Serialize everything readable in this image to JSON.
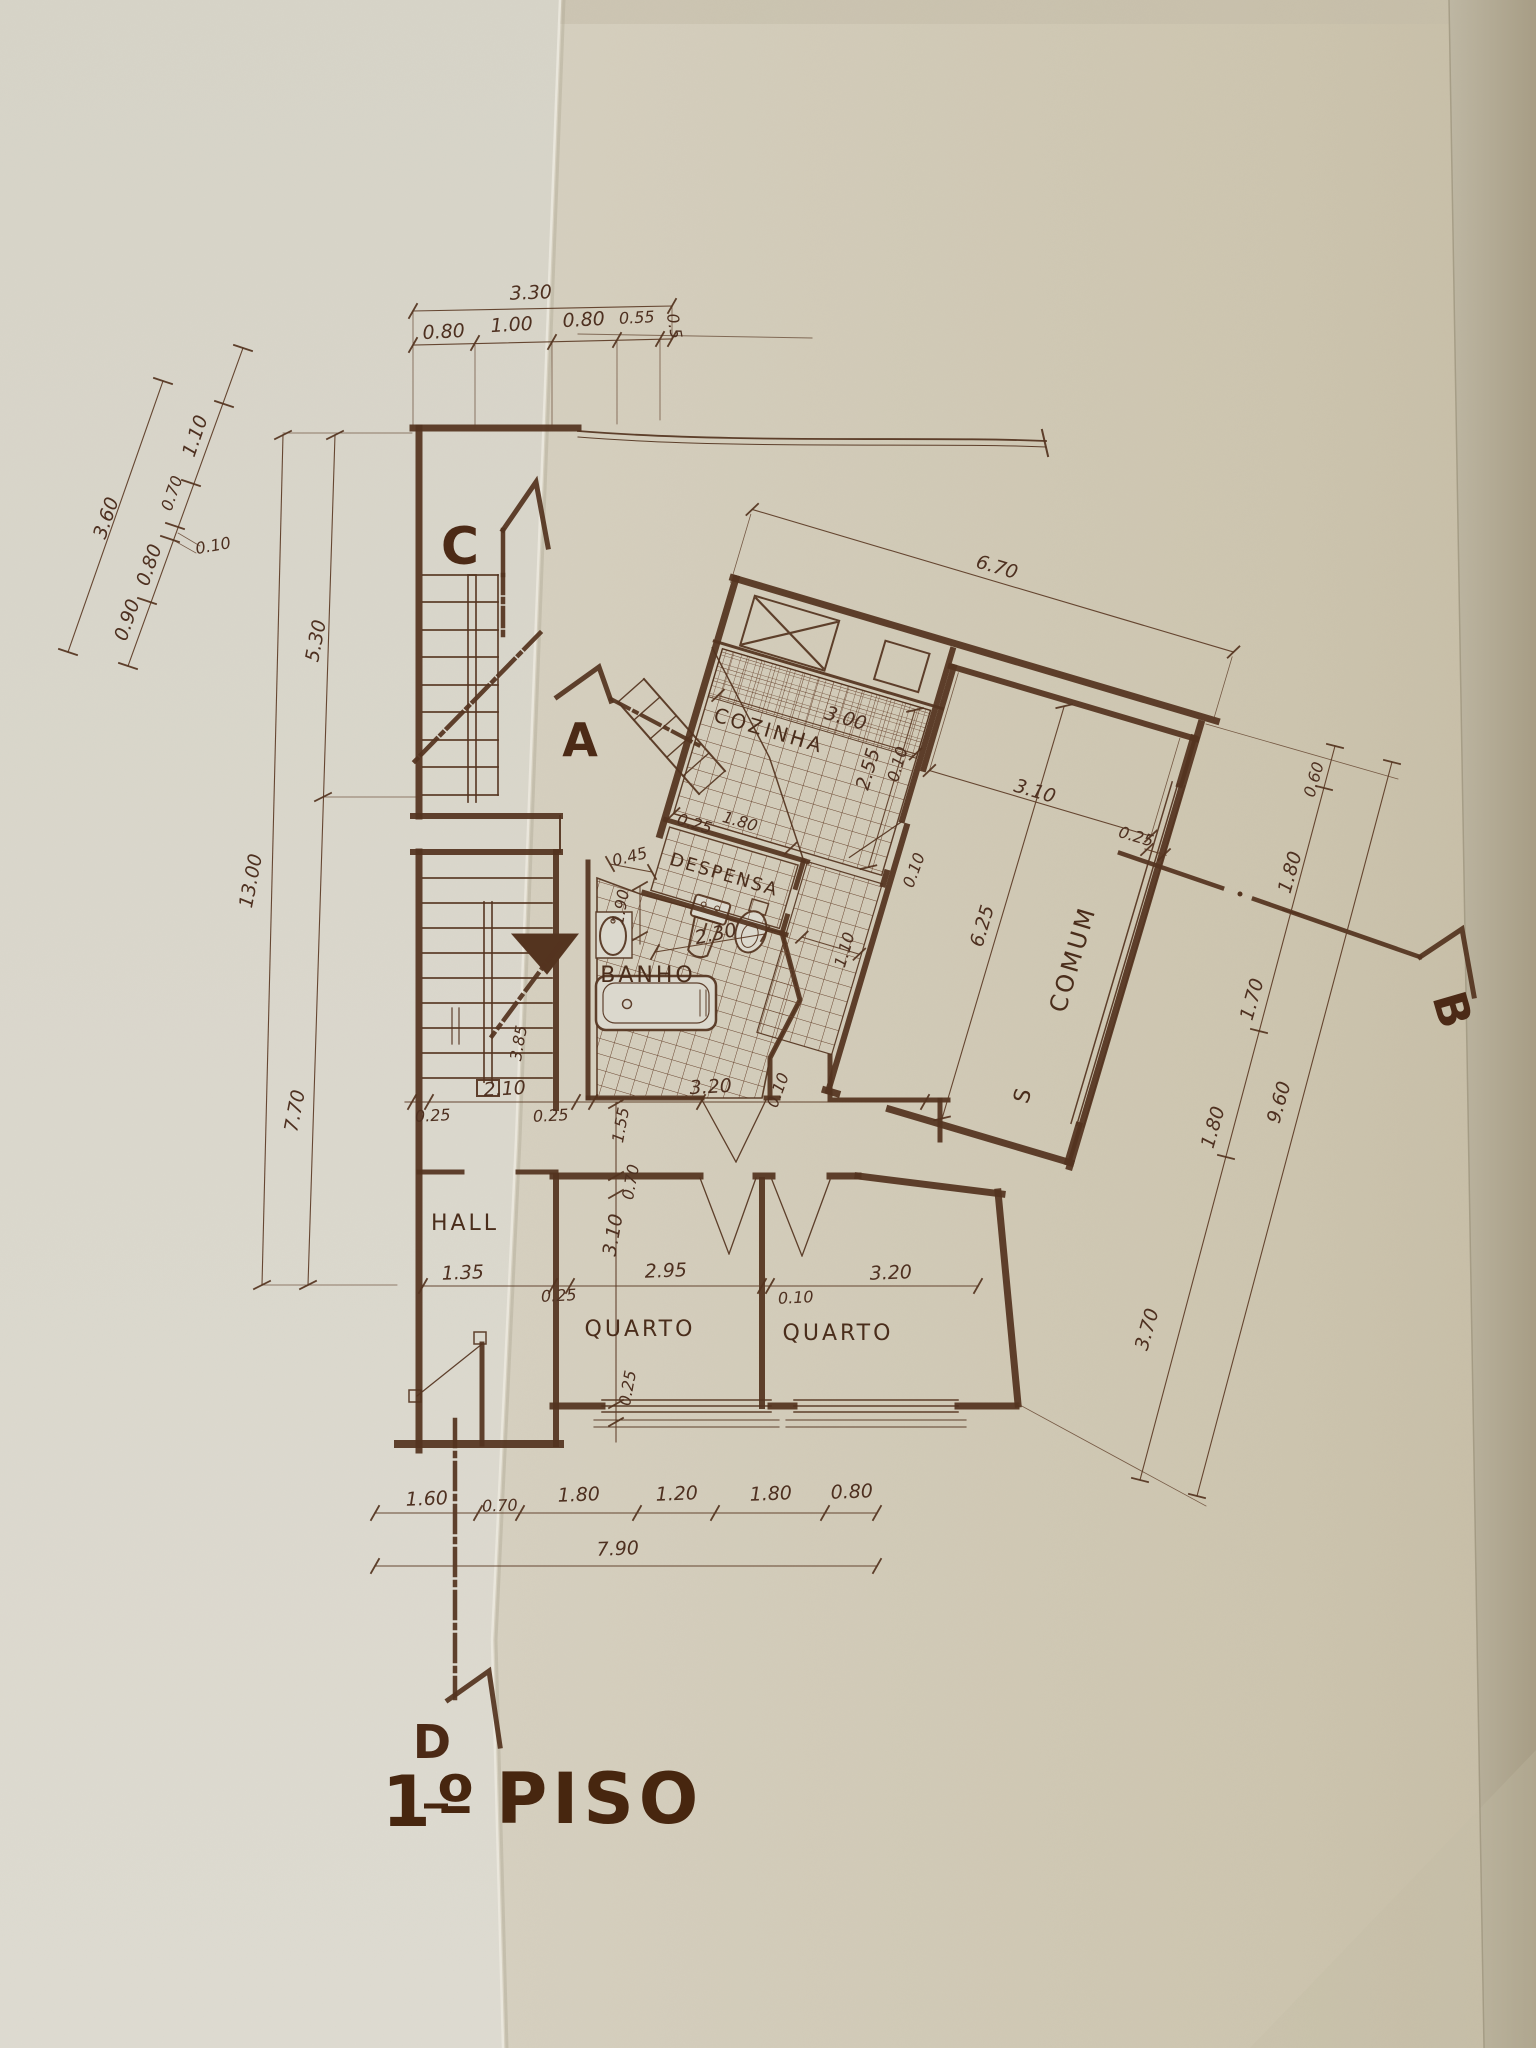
{
  "title": {
    "number": "1º",
    "text": "PISO"
  },
  "rooms": {
    "hall": "HALL",
    "cozinha": "COZINHA",
    "despensa": "DESPENSA",
    "banho": "BANHO",
    "quarto_left": "QUARTO",
    "quarto_right": "QUARTO",
    "comum": "COMUM",
    "comum_s": "S"
  },
  "section_markers": {
    "a": "A",
    "b": "B",
    "c": "C",
    "d": "D"
  },
  "dims": {
    "t330": "3.30",
    "t080a": "0.80",
    "t100": "1.00",
    "t080b": "0.80",
    "t055": "0.55",
    "t005": "0.5",
    "ld360": "3.60",
    "ld110": "1.10",
    "ld070": "0.70",
    "ld010": "0.10",
    "ld080": "0.80",
    "ld090": "0.90",
    "lv1300": "13.00",
    "lv530": "5.30",
    "lv770": "7.70",
    "k670": "6.70",
    "k300": "3.00",
    "k255": "2.55",
    "k010": "0.10",
    "d025": "0.25",
    "d180": "1.80",
    "d045": "0.45",
    "d010": "0.10",
    "b190": "1.90",
    "b230": "2.30",
    "b110": "1.10",
    "c310": "3.10",
    "c025": "0.25",
    "c625": "6.25",
    "m385": "3.85",
    "m025a": "0.25",
    "m210": "2.10",
    "m025b": "0.25",
    "m155": "1.55",
    "m320": "3.20",
    "m010": "0.10",
    "q135": "1.35",
    "q025a": "0.25",
    "q295": "2.95",
    "q010": "0.10",
    "q320": "3.20",
    "q070": "0.70",
    "q310": "3.10",
    "q025b": "0.25",
    "bt160": "1.60",
    "bt070": "0.70",
    "bt180a": "1.80",
    "bt120": "1.20",
    "bt180b": "1.80",
    "bt080": "0.80",
    "bt790": "7.90",
    "r060": "0.60",
    "r180a": "1.80",
    "r170": "1.70",
    "r180b": "1.80",
    "r370": "3.70",
    "r960": "9.60"
  },
  "colors": {
    "paper_left": "#dbd8cd",
    "paper_right": "#cfc8b4",
    "paper_edge": "#ab9f87",
    "ink": "#54341f"
  }
}
